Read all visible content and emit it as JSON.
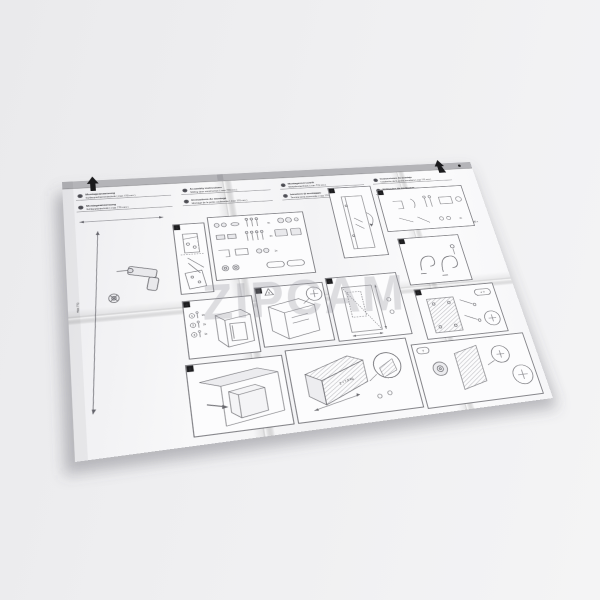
{
  "scene": {
    "background": "#ededef",
    "shadow": "rgba(90,90,98,0.30)"
  },
  "sheet": {
    "paper": "#f9f9fa",
    "fold_band": "#b4b4b8",
    "ink": "#2a2a2e",
    "line": "#63636a",
    "hatch": "#9a9aa0"
  },
  "watermark": {
    "text": "ZIPCAM"
  },
  "header": {
    "groups": [
      {
        "rows": [
          {
            "badge": "D",
            "title": "Montageanweisung",
            "subtitle": "Schleppscharniertechnik ( max 770 mm )"
          },
          {
            "badge": "CH",
            "title": "Montageanweisung",
            "subtitle": "Schlepptürtechnik ( max 770 mm )"
          }
        ]
      },
      {
        "rows": [
          {
            "badge": "GB",
            "title": "Assembly instructions",
            "subtitle": "Sliding door construction ( max 770 mm )"
          },
          {
            "badge": "F",
            "title": "Instructions de montage",
            "subtitle": "Montage de la porte coulissante ( max 770 mm )"
          }
        ]
      },
      {
        "rows": [
          {
            "badge": "NL",
            "title": "Montagevoorschrift",
            "subtitle": "Sleepdeurtechniek ( max 770 mm )"
          },
          {
            "badge": "I",
            "title": "Istruzioni di montaggio",
            "subtitle": "Tecnica porta scorrevole ( max 770 mm )"
          }
        ]
      },
      {
        "rows": [
          {
            "badge": "E",
            "title": "Instrucciones de montaje",
            "subtitle": "Instalación de la puerta corredera ( max 770 mm )"
          },
          {
            "badge": "P",
            "title": "Instruções de montagem",
            "subtitle": "Instalação da porta corrediça ( max 770 mm )"
          }
        ]
      }
    ]
  },
  "margins": {
    "height_label": "max 770",
    "tool_label": "Ø2 x"
  },
  "parts": {
    "counts": [
      "4x",
      "2x",
      "1x"
    ]
  },
  "panels": {
    "p1": {
      "step": "1"
    },
    "p2": {
      "step": "2"
    },
    "p3": {
      "step": "3",
      "count": "2x"
    },
    "p4": {
      "step": "4",
      "callouts": [
        {
          "n": "1",
          "c": "2x"
        },
        {
          "n": "2",
          "c": "2x"
        },
        {
          "n": "3",
          "c": "1x"
        }
      ]
    },
    "p5": {
      "step": "5",
      "mark": "!"
    },
    "p6": {
      "step": "6"
    },
    "p7": {
      "step": "7"
    },
    "p8": {
      "step": "8",
      "pill": "+ ?"
    },
    "p9": {
      "step": "9"
    },
    "p10": {
      "weight": "2 + 7,5 kg"
    },
    "p11": {
      "pill": "?"
    }
  }
}
